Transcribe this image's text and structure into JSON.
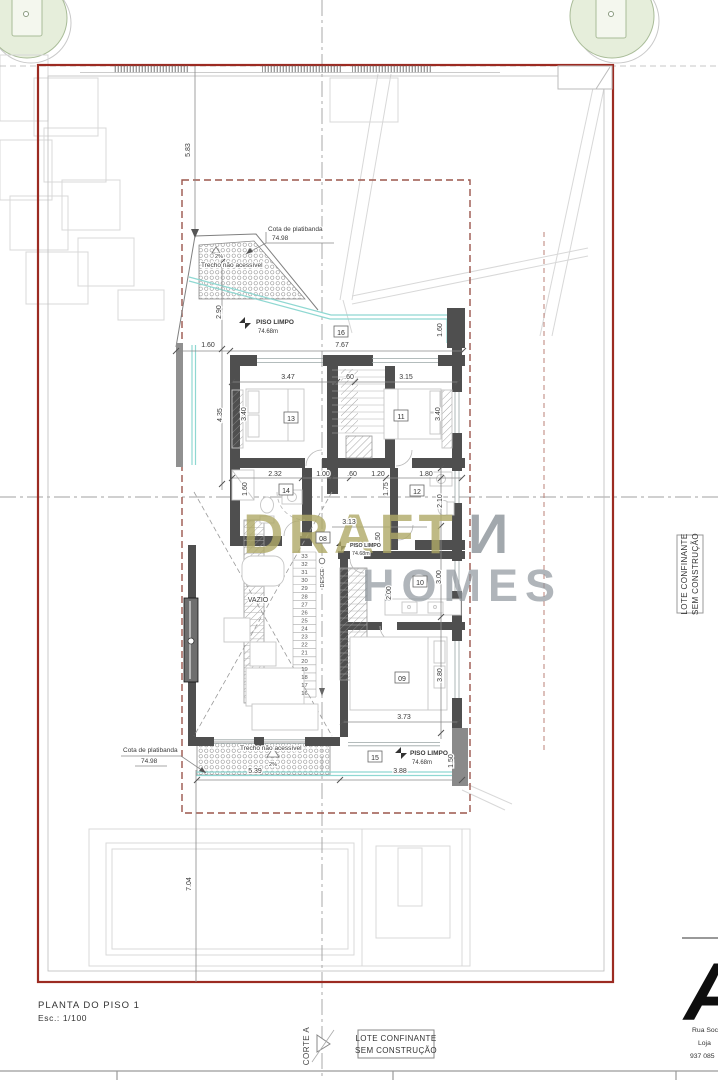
{
  "colors": {
    "lot_border_red": "#9c2b22",
    "boundary_dashed": "#9b564c",
    "wall_gray": "#4f4f4f",
    "accent_teal": "#8fd8d2",
    "tree_green_fill": "#e6eedb",
    "tree_green_stroke": "#a9bc98",
    "watermark_olive": "#b0aa67",
    "watermark_gray": "#8f979d"
  },
  "title_block": {
    "title": "PLANTA DO PISO 1",
    "scale": "Esc.: 1/100"
  },
  "section_marker": {
    "label": "CORTE A"
  },
  "adjacent_lot_bottom": {
    "line1": "LOTE CONFINANTE",
    "line2": "SEM CONSTRUÇÃO"
  },
  "adjacent_lot_right": {
    "line1": "LOTE CONFINANTE",
    "line2": "SEM CONSTRUÇÃO"
  },
  "watermark": {
    "word1": "DRAFT",
    "word2": "И",
    "word3": "HOMES"
  },
  "logo": {
    "letter": "A",
    "address_lines": [
      "Rua Soci",
      "Loja",
      "937 085"
    ]
  },
  "room_tags": [
    {
      "n": "16",
      "x": 341,
      "y": 332
    },
    {
      "n": "13",
      "x": 291,
      "y": 418
    },
    {
      "n": "11",
      "x": 401,
      "y": 416
    },
    {
      "n": "14",
      "x": 286,
      "y": 490
    },
    {
      "n": "12",
      "x": 417,
      "y": 491
    },
    {
      "n": "08",
      "x": 323,
      "y": 538
    },
    {
      "n": "10",
      "x": 420,
      "y": 582
    },
    {
      "n": "09",
      "x": 402,
      "y": 678
    },
    {
      "n": "15",
      "x": 375,
      "y": 757
    }
  ],
  "dimensions": [
    {
      "t": "5.83",
      "x": 190,
      "y": 150,
      "r": -90
    },
    {
      "t": "2.90",
      "x": 221,
      "y": 312,
      "r": -90
    },
    {
      "t": "1.60",
      "x": 208,
      "y": 347,
      "r": 0
    },
    {
      "t": "7.67",
      "x": 342,
      "y": 347,
      "r": 0
    },
    {
      "t": "1.60",
      "x": 442,
      "y": 330,
      "r": -90
    },
    {
      "t": "3.47",
      "x": 288,
      "y": 379,
      "r": 0
    },
    {
      "t": ".60",
      "x": 349,
      "y": 379,
      "r": 0
    },
    {
      "t": "3.15",
      "x": 406,
      "y": 379,
      "r": 0
    },
    {
      "t": "4.35",
      "x": 222,
      "y": 415,
      "r": -90
    },
    {
      "t": "3.40",
      "x": 246,
      "y": 414,
      "r": -90
    },
    {
      "t": "3.40",
      "x": 440,
      "y": 414,
      "r": -90
    },
    {
      "t": "2.32",
      "x": 275,
      "y": 476,
      "r": 0
    },
    {
      "t": "1.00",
      "x": 323,
      "y": 476,
      "r": 0
    },
    {
      "t": ".60",
      "x": 352,
      "y": 476,
      "r": 0
    },
    {
      "t": "1.20",
      "x": 378,
      "y": 476,
      "r": 0
    },
    {
      "t": "1.80",
      "x": 426,
      "y": 476,
      "r": 0
    },
    {
      "t": "1.60",
      "x": 247,
      "y": 489,
      "r": -90
    },
    {
      "t": "1.75",
      "x": 388,
      "y": 489,
      "r": -90
    },
    {
      "t": "2.10",
      "x": 442,
      "y": 501,
      "r": -90
    },
    {
      "t": "3.13",
      "x": 349,
      "y": 524,
      "r": 0
    },
    {
      "t": "1.50",
      "x": 380,
      "y": 539,
      "r": -90
    },
    {
      "t": "2.00",
      "x": 391,
      "y": 593,
      "r": -90
    },
    {
      "t": "3.00",
      "x": 441,
      "y": 577,
      "r": -90
    },
    {
      "t": "3.80",
      "x": 442,
      "y": 675,
      "r": -90
    },
    {
      "t": "3.73",
      "x": 404,
      "y": 719,
      "r": 0
    },
    {
      "t": "5.39",
      "x": 255,
      "y": 773,
      "r": 0
    },
    {
      "t": "3.88",
      "x": 400,
      "y": 773,
      "r": 0
    },
    {
      "t": "1.50",
      "x": 453,
      "y": 761,
      "r": -90
    },
    {
      "t": "7.04",
      "x": 191,
      "y": 884,
      "r": -90
    }
  ],
  "annotations": [
    {
      "t": "Cota de platibanda",
      "x": 268,
      "y": 231,
      "s": 6.5,
      "a": "start"
    },
    {
      "t": "74.98",
      "x": 272,
      "y": 240,
      "s": 6.5,
      "a": "start"
    },
    {
      "t": "Trecho não acessível",
      "x": 201,
      "y": 267,
      "s": 6.5,
      "a": "start"
    },
    {
      "t": "2%",
      "x": 219,
      "y": 258,
      "s": 5.5,
      "a": "middle"
    },
    {
      "t": "PISO LIMPO",
      "x": 256,
      "y": 324,
      "s": 6.5,
      "a": "start",
      "b": 1
    },
    {
      "t": "74.68m",
      "x": 258,
      "y": 333,
      "s": 6,
      "a": "start"
    },
    {
      "t": "PISO LIMPO",
      "x": 350,
      "y": 547,
      "s": 5.3,
      "a": "start",
      "b": 1
    },
    {
      "t": "74.68m",
      "x": 352,
      "y": 555,
      "s": 5.3,
      "a": "start"
    },
    {
      "t": "PISO LIMPO",
      "x": 410,
      "y": 755,
      "s": 6.5,
      "a": "start",
      "b": 1
    },
    {
      "t": "74.68m",
      "x": 412,
      "y": 764,
      "s": 6,
      "a": "start"
    },
    {
      "t": "Cota de platibanda",
      "x": 123,
      "y": 752,
      "s": 6.5,
      "a": "start"
    },
    {
      "t": "74.98",
      "x": 141,
      "y": 763,
      "s": 6.5,
      "a": "start"
    },
    {
      "t": "Trecho não acessível",
      "x": 240,
      "y": 750,
      "s": 6.5,
      "a": "start"
    },
    {
      "t": "2%",
      "x": 273,
      "y": 766,
      "s": 5.5,
      "a": "middle"
    },
    {
      "t": "VAZIO",
      "x": 258,
      "y": 602,
      "s": 7,
      "a": "middle"
    },
    {
      "t": "DESCE",
      "x": 324,
      "y": 578,
      "s": 5.5,
      "a": "middle",
      "r": -90
    }
  ],
  "stair": {
    "direction_label": "DESCE",
    "numbers": [
      "33",
      "32",
      "31",
      "30",
      "29",
      "28",
      "27",
      "26",
      "25",
      "24",
      "23",
      "22",
      "21",
      "20",
      "19",
      "18",
      "17",
      "16"
    ]
  }
}
